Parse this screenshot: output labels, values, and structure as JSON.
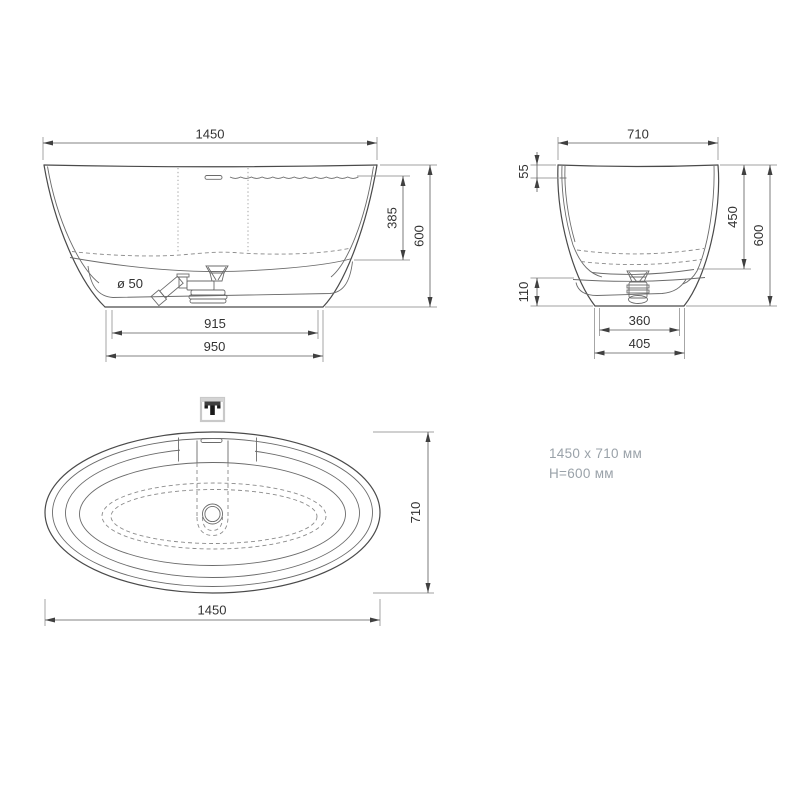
{
  "front_view": {
    "width": "1450",
    "water_depth": "385",
    "height": "600",
    "base_inner_width": "915",
    "base_width": "950",
    "drain_diameter": "ø 50"
  },
  "side_view": {
    "width": "710",
    "rim_offset": "55",
    "basin_depth": "450",
    "height": "600",
    "base_height": "110",
    "base_inner_width": "360",
    "base_width": "405"
  },
  "top_view": {
    "length": "1450",
    "width": "710"
  },
  "summary": {
    "dimensions": "1450 x 710 мм",
    "height": "H=600 мм"
  },
  "colors": {
    "outline": "#4a4a4a",
    "dimension_text": "#333333",
    "summary_text": "#9aa2a9"
  }
}
